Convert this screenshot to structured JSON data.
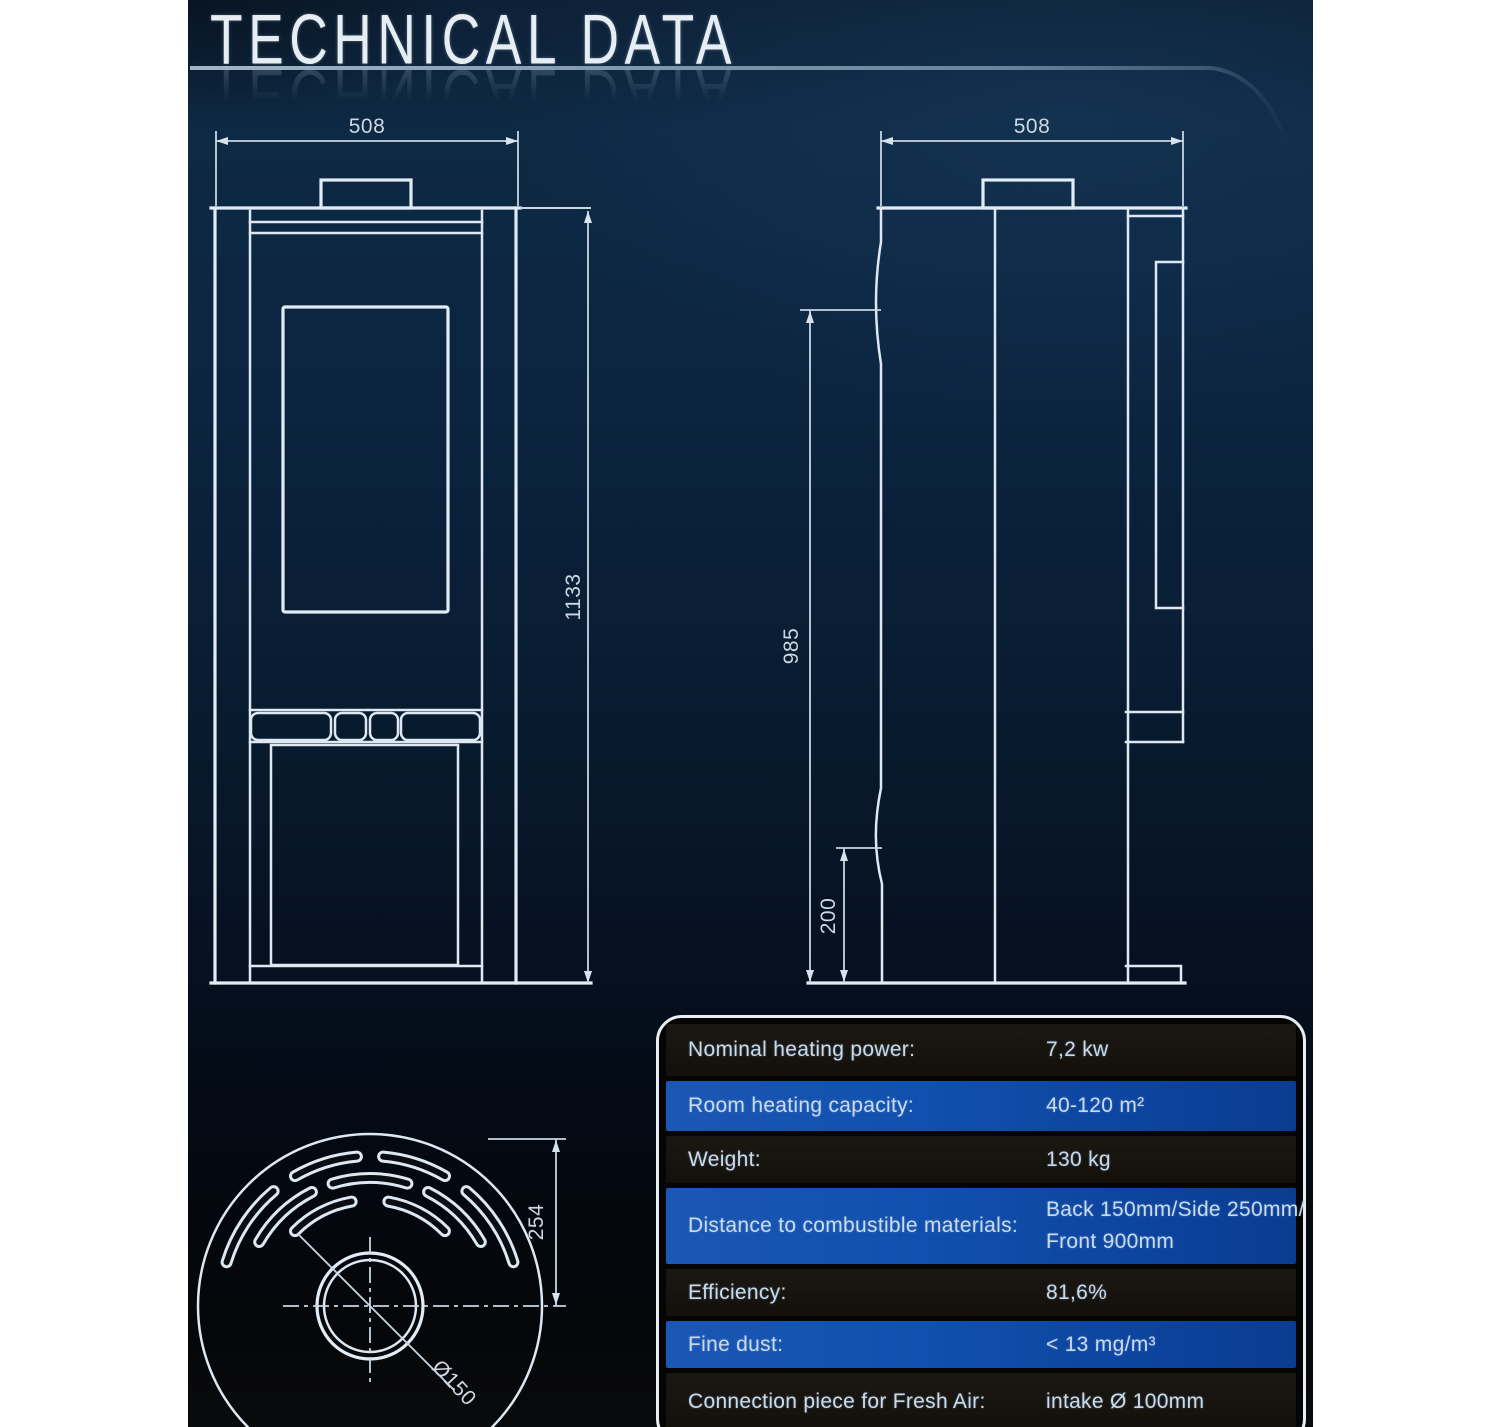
{
  "page": {
    "title": "TECHNICAL DATA"
  },
  "dimensions": {
    "front_width": "508",
    "front_height": "1133",
    "side_depth": "508",
    "side_body_height": "985",
    "side_base_height": "200",
    "top_radius": "254",
    "flue_diameter": "Ø150"
  },
  "table": {
    "rows": [
      {
        "label": "Nominal heating power:",
        "value": "7,2 kw"
      },
      {
        "label": "Room heating capacity:",
        "value": "40-120 m²"
      },
      {
        "label": "Weight:",
        "value": "130 kg"
      },
      {
        "label": "Distance to combustible materials:",
        "value": "Back 150mm/Side 250mm/",
        "value2": "Front 900mm"
      },
      {
        "label": "Efficiency:",
        "value": "81,6%"
      },
      {
        "label": "Fine dust:",
        "value": "< 13 mg/m³"
      },
      {
        "label": "Connection piece for Fresh Air:",
        "value": "intake Ø 100mm"
      }
    ]
  },
  "colors": {
    "panel_navy": "#0d2640",
    "accent_blue": "#1150ae",
    "line": "#dde8f2",
    "page_margin": "#ffffff"
  }
}
